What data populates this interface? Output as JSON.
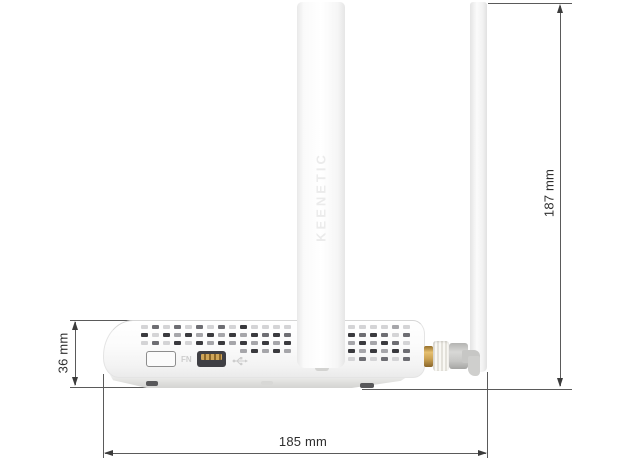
{
  "diagram": {
    "dimensions": {
      "total_height": "187 mm",
      "body_height": "36 mm",
      "total_width": "185 mm"
    },
    "device": {
      "brand_embossed": "KEENETIC",
      "fn_button_label": "FN",
      "icons": [
        "usb-icon"
      ]
    },
    "colors": {
      "dimension_line": "#5a5a5a",
      "dimension_text": "#2e2e2e",
      "body_white": "#fbfbfb",
      "connector_gold": "#cda455",
      "connector_gray": "#c6c6c4",
      "vent_dark": "#3a3a3e"
    }
  }
}
